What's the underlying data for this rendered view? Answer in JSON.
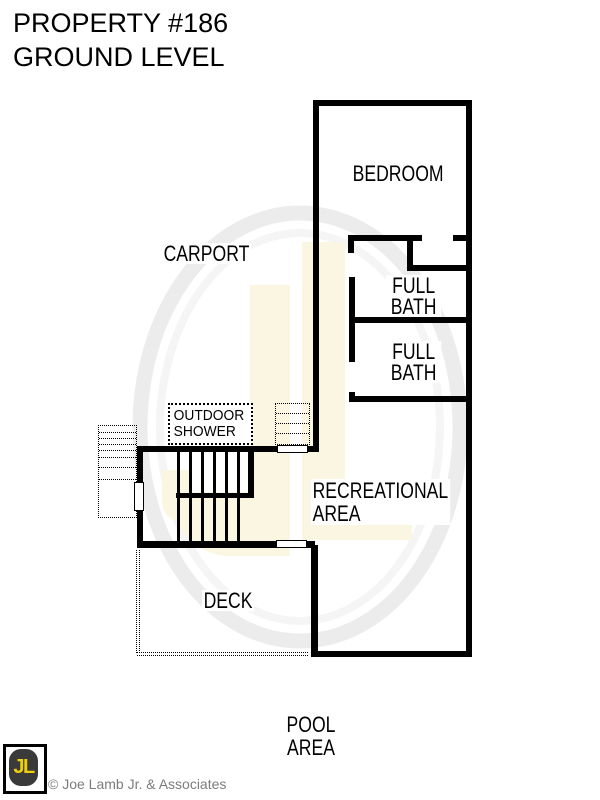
{
  "title": {
    "line1": "PROPERTY #186",
    "line2": "GROUND LEVEL"
  },
  "rooms": {
    "bedroom": "BEDROOM",
    "carport": "CARPORT",
    "full_bath_upper": "FULL\nBATH",
    "full_bath_lower": "FULL\nBATH",
    "outdoor_shower": "OUTDOOR\nSHOWER",
    "recreational_area": "RECREATIONAL\nAREA",
    "deck": "DECK",
    "pool_area": "POOL\nAREA"
  },
  "watermark": {
    "letters": "JL"
  },
  "footer": {
    "logo_letters": "JL",
    "copyright": "© Joe Lamb Jr. & Associates"
  },
  "colors": {
    "wall": "#000000",
    "background": "#ffffff",
    "watermark_letters": "#fbf6e1",
    "watermark_ring": "#ececec",
    "logo_yellow": "#efce0a",
    "logo_dark": "#3a3a3a",
    "copyright_gray": "#7c7c7c"
  }
}
